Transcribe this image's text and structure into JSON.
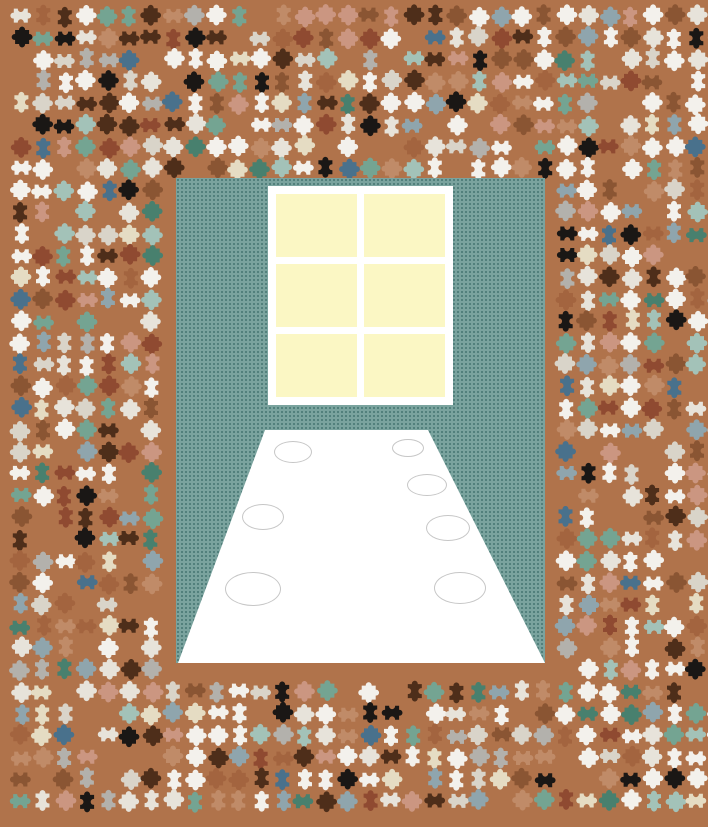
{
  "app": {
    "name": "jigsaw-puzzle-game",
    "description": "Jigsaw puzzle in progress: Thanksgiving turkeys seated at a long dinner table; unplaced pieces scattered around the assembled center image",
    "canvas": {
      "width": 708,
      "height": 827
    }
  },
  "colors": {
    "background": "#b0734b",
    "wall": "#7aa39e",
    "wall_dot": "#4f7d79",
    "window_frame": "#ffffff",
    "window_pane": "#fbf7c4",
    "table": "#ffffff",
    "plate_stroke": "#c6c6c6",
    "eye": "#141210",
    "beak": "#efe3a8",
    "wattle": "#f09cb4"
  },
  "board": {
    "x": 176,
    "y": 178,
    "width": 369,
    "height": 485
  },
  "scene": {
    "window": {
      "x": 268,
      "y": 186,
      "width": 185,
      "height": 219,
      "rows": 3,
      "cols": 2,
      "pane_count": 6
    },
    "table": {
      "polygon": [
        [
          265,
          430
        ],
        [
          428,
          430
        ],
        [
          545,
          663
        ],
        [
          178,
          663
        ]
      ],
      "plates": [
        {
          "cx": 293,
          "cy": 452,
          "rx": 19,
          "ry": 11
        },
        {
          "cx": 263,
          "cy": 517,
          "rx": 21,
          "ry": 13
        },
        {
          "cx": 253,
          "cy": 589,
          "rx": 28,
          "ry": 17
        },
        {
          "cx": 408,
          "cy": 448,
          "rx": 16,
          "ry": 9
        },
        {
          "cx": 427,
          "cy": 485,
          "rx": 20,
          "ry": 11
        },
        {
          "cx": 448,
          "cy": 528,
          "rx": 22,
          "ry": 13
        },
        {
          "cx": 460,
          "cy": 588,
          "rx": 26,
          "ry": 16
        }
      ]
    },
    "turkeys": [
      {
        "side": "left",
        "x": 208,
        "y": 416,
        "w": 64,
        "h": 92,
        "rot": 8,
        "color": "#a4473d",
        "eyes": [
          [
            253,
            430
          ],
          [
            241,
            447
          ]
        ],
        "spots": [],
        "beak": [
          257,
          440
        ],
        "wattle": [
          254,
          449
        ]
      },
      {
        "side": "left",
        "x": 194,
        "y": 482,
        "w": 56,
        "h": 78,
        "rot": 16,
        "color": "#96684a",
        "eyes": [
          [
            224,
            500
          ],
          [
            214,
            512
          ]
        ],
        "spots": [],
        "beak": [
          227,
          514
        ],
        "wattle": [
          224,
          521
        ]
      },
      {
        "side": "left",
        "x": 170,
        "y": 531,
        "w": 64,
        "h": 106,
        "rot": 10,
        "color": "#a3714b",
        "eyes": [
          [
            217,
            547
          ],
          [
            184,
            568
          ]
        ],
        "spots": [],
        "beak": [
          199,
          574
        ],
        "wattle": [
          205,
          579
        ]
      },
      {
        "side": "right",
        "x": 422,
        "y": 410,
        "w": 50,
        "h": 56,
        "rot": -10,
        "color": "#8f6240",
        "eyes": [
          [
            438,
            420
          ],
          [
            449,
            429
          ]
        ],
        "spots": [
          [
            456,
            438
          ]
        ],
        "beak": [
          435,
          431
        ],
        "wattle": [
          433,
          438
        ]
      },
      {
        "side": "right",
        "x": 440,
        "y": 434,
        "w": 52,
        "h": 82,
        "rot": -14,
        "color": "#a87c58",
        "eyes": [
          [
            463,
            448
          ],
          [
            473,
            462
          ]
        ],
        "spots": [
          [
            480,
            485
          ]
        ],
        "beak": [
          460,
          467
        ],
        "wattle": [
          458,
          474
        ]
      },
      {
        "side": "right",
        "x": 465,
        "y": 480,
        "w": 56,
        "h": 92,
        "rot": -12,
        "color": "#9b6d4a",
        "eyes": [
          [
            492,
            493
          ],
          [
            502,
            511
          ]
        ],
        "spots": [
          [
            508,
            487
          ]
        ],
        "beak": [
          483,
          513
        ],
        "wattle": [
          481,
          519
        ]
      },
      {
        "side": "right",
        "x": 482,
        "y": 526,
        "w": 66,
        "h": 112,
        "rot": -10,
        "color": "#8a5c3e",
        "eyes": [
          [
            512,
            543
          ],
          [
            527,
            552
          ]
        ],
        "spots": [
          [
            533,
            578
          ]
        ],
        "beak": [
          505,
          562
        ],
        "wattle": [
          503,
          570
        ]
      }
    ]
  },
  "pieces": {
    "seed": 1337,
    "start_x": 9,
    "start_y": 4,
    "pitch": 21.8,
    "cols": 33,
    "rows": 37,
    "cell_size": 24,
    "gap_probability": 0.12,
    "rotations": [
      0,
      90,
      180,
      270
    ],
    "exclusion_inset": 3,
    "palette": [
      {
        "c": "#f3f1ec",
        "w": 18
      },
      {
        "c": "#e7e3da",
        "w": 8
      },
      {
        "c": "#d9d4c9",
        "w": 5
      },
      {
        "c": "#1a1715",
        "w": 6
      },
      {
        "c": "#4e2e1a",
        "w": 6
      },
      {
        "c": "#8a5533",
        "w": 7
      },
      {
        "c": "#a3643f",
        "w": 5
      },
      {
        "c": "#c08b68",
        "w": 6
      },
      {
        "c": "#cb9681",
        "w": 6
      },
      {
        "c": "#e5dcc3",
        "w": 4
      },
      {
        "c": "#74a492",
        "w": 6
      },
      {
        "c": "#a3c2b8",
        "w": 4
      },
      {
        "c": "#48806e",
        "w": 3
      },
      {
        "c": "#8fa5ad",
        "w": 5
      },
      {
        "c": "#49718c",
        "w": 3
      },
      {
        "c": "#b3b1ac",
        "w": 4
      },
      {
        "c": "#8f4a31",
        "w": 4
      }
    ]
  }
}
